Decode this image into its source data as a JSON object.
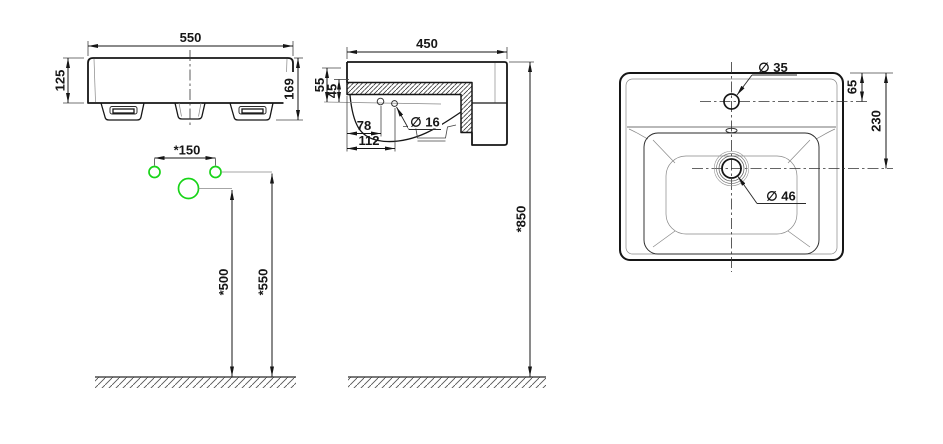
{
  "colors": {
    "line": "#161616",
    "thin_line": "#888888",
    "accent_green": "#17d417",
    "background": "#ffffff"
  },
  "front_view": {
    "width_label": "550",
    "body_height_label": "125",
    "overall_height_label": "169"
  },
  "installation": {
    "tap_hole_spacing_label": "*150",
    "spout_height_label": "*500",
    "tap_holes_height_label": "*550"
  },
  "side_view": {
    "depth_label": "450",
    "top_to_hole_label": "55",
    "rim_to_hole_label": "45",
    "fixing_hole_x1_label": "78",
    "fixing_hole_x2_label": "112",
    "fixing_hole_dia_label": "∅ 16",
    "rim_height_label": "*850"
  },
  "top_view": {
    "tap_hole_dia_label": "∅ 35",
    "tap_hole_offset_label": "65",
    "drain_offset_label": "230",
    "drain_dia_label": "∅ 46"
  }
}
